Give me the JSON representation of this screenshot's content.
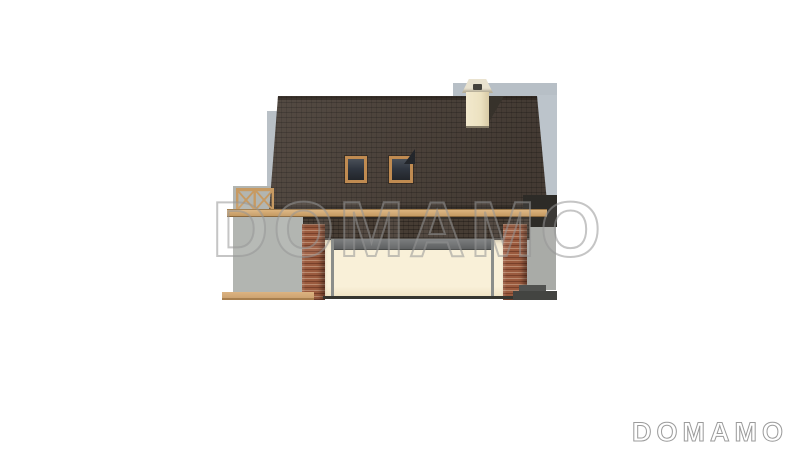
{
  "watermark": {
    "text": "DOMAMO"
  },
  "footer_logo": {
    "text": "DOMAMO"
  },
  "scene": {
    "description": "Architectural side elevation rendering of a single-family house with attic, garage front and terrace",
    "background_color": "#ffffff",
    "colors": {
      "roof_tiles": "#4b4139",
      "fascia_wood": "#c49a62",
      "window_frame_wood": "#c08b51",
      "wall_gray_blue": "#b9c0c6",
      "wall_gray": "#b2b5b1",
      "garage_door_cream": "#f9f0d8",
      "brick_pillar": "#9a5a3e",
      "chimney_cream": "#ece1c0",
      "deck_wood": "#cda371",
      "steps_gray": "#434441"
    },
    "elements": [
      "main-roof",
      "roof-ridge",
      "roof-window-left",
      "roof-window-right",
      "chimney",
      "chimney-cap",
      "fascia-beam",
      "terrace-railing",
      "lower-roof",
      "garage-beam",
      "garage-door",
      "door-posts",
      "brick-pillar-left",
      "brick-pillar-right",
      "terrace-deck",
      "entry-steps",
      "background-walls"
    ]
  }
}
